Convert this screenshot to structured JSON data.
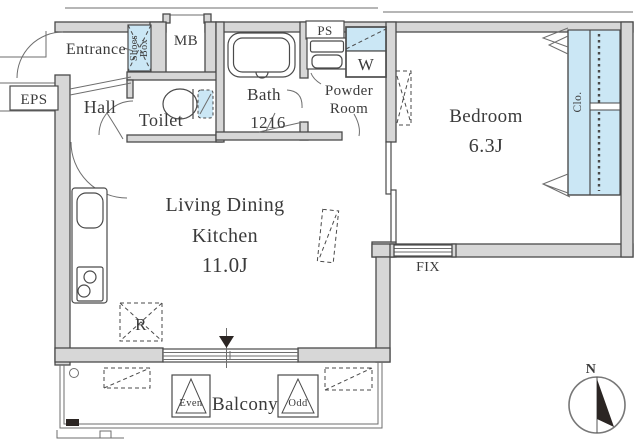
{
  "colors": {
    "wall": "#d7d7d7",
    "line": "#4a4a4a",
    "thin": "#6e6e6e",
    "blue": "#cbe7f5",
    "text": "#3b3b3b",
    "bg": "#ffffff",
    "dark": "#2b2523"
  },
  "plan": {
    "labels": {
      "entrance": "Entrance",
      "shoes_box_line1": "Shoes",
      "shoes_box_line2": "Box",
      "mb": "MB",
      "eps": "EPS",
      "hall": "Hall",
      "toilet": "Toilet",
      "bath_line1": "Bath",
      "bath_line2": "1216",
      "ps": "PS",
      "powder_line1": "Powder",
      "powder_line2": "Room",
      "washer": "W",
      "bedroom_name": "Bedroom",
      "bedroom_size": "6.3J",
      "closet": "Clo.",
      "ldk_line1": "Living Dining",
      "ldk_line2": "Kitchen",
      "ldk_size": "11.0J",
      "fix_window": "FIX",
      "refrigerator": "R",
      "balcony": "Balcony",
      "hatch_even": "Even",
      "hatch_odd": "Odd",
      "north": "N"
    }
  }
}
